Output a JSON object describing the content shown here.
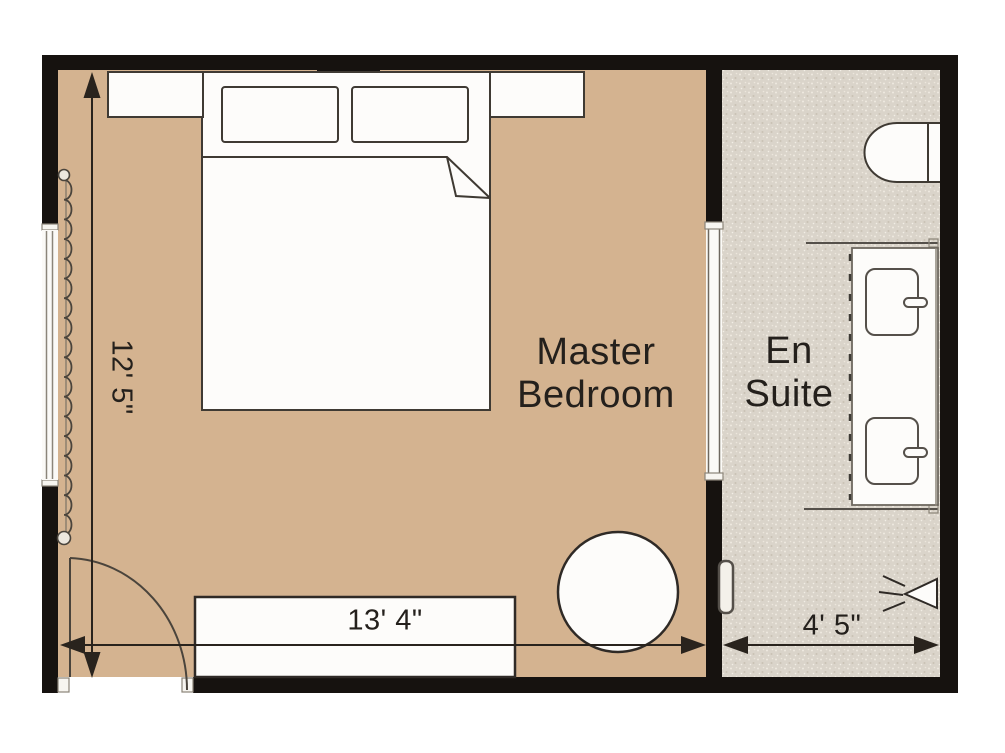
{
  "plan_title": "Master Bedroom and En Suite floor plan",
  "labels": {
    "master_bedroom": {
      "line1": "Master",
      "line2": "Bedroom"
    },
    "en_suite": {
      "line1": "En",
      "line2": "Suite"
    }
  },
  "dimensions": {
    "bedroom_height": "12' 5\"",
    "bedroom_width": "13' 4\"",
    "ensuite_width": "4' 5\""
  },
  "colors": {
    "bedroom_floor": "#d4b390",
    "ensuite_floor_base": "#dad4ca",
    "wall": "#16120f",
    "furniture_fill": "#fdfcfa",
    "outline": "#3f3a33",
    "dimension": "#29231d",
    "text": "#24201c"
  },
  "furniture_icons": [
    "double-bed-icon",
    "pillow-icon",
    "nightstand-icon",
    "dresser-icon",
    "round-chair-icon",
    "door-swing-icon",
    "window-icon",
    "curtain-icon",
    "toilet-icon",
    "vanity-icon",
    "sink-icon",
    "faucet-icon",
    "shower-head-icon",
    "wall-handle-icon"
  ]
}
